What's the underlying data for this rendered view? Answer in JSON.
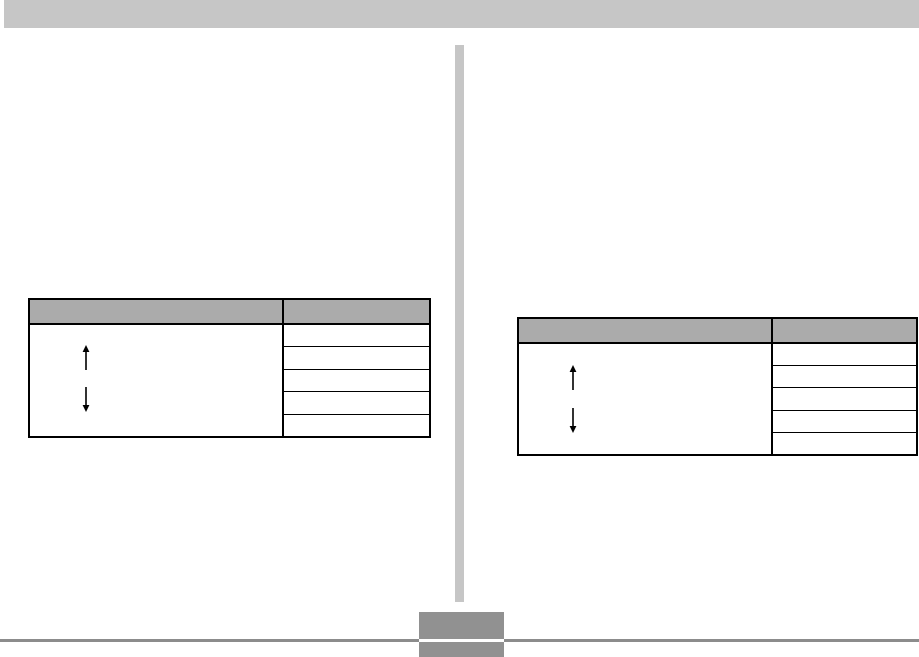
{
  "page": {
    "width": 919,
    "height": 657,
    "kind": "scanned-manual-page",
    "visible_text": ""
  },
  "colors": {
    "page-bg": "#ffffff",
    "top-bar": "#c6c6c6",
    "divider-strip": "#c6c6c6",
    "table-header-fill": "#ababab",
    "table-border": "#000000",
    "arrow": "#000000",
    "footer-rule": "#8c8c8c",
    "page-tab": "#919191"
  },
  "tables": [
    {
      "id": "left",
      "header_cells": [
        "",
        ""
      ],
      "header_cells_empty": true,
      "body_rows": 5,
      "body_rows_empty": true,
      "left_cell_icons": [
        "up-arrow-icon",
        "down-arrow-icon"
      ]
    },
    {
      "id": "right",
      "header_cells": [
        "",
        ""
      ],
      "header_cells_empty": true,
      "body_rows": 5,
      "body_rows_empty": true,
      "left_cell_icons": [
        "up-arrow-icon",
        "down-arrow-icon"
      ]
    }
  ],
  "footer": {
    "rule": "full-width horizontal rule interrupted by page tab",
    "page_tab_text": ""
  }
}
